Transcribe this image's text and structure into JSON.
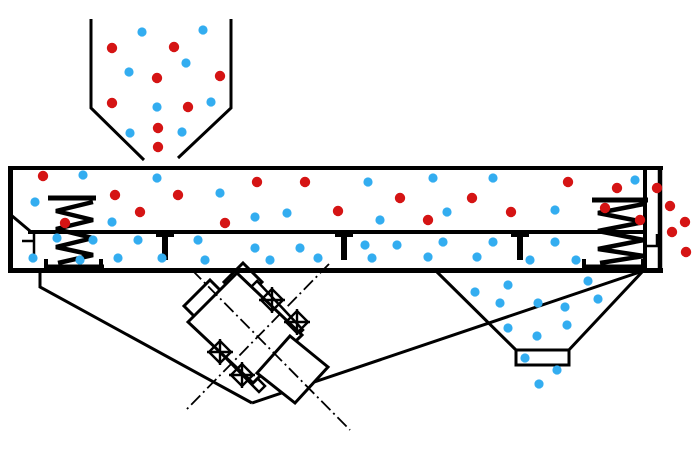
{
  "diagram": {
    "type": "technical-schematic",
    "subject": "linear vibrating screen side view with particle flow",
    "background_color": "#ffffff",
    "line_color": "#000000",
    "particle_colors": {
      "coarse": "#d51414",
      "fine": "#33adf0"
    },
    "particle_radius": {
      "coarse": 5.2,
      "fine": 4.6
    },
    "components": [
      "feed-hopper",
      "screen-box",
      "screen-mesh",
      "mesh-supports",
      "left-support-spring",
      "right-support-spring",
      "vibration-motor",
      "motor-centerlines",
      "motor-bolts",
      "chute-frame",
      "fines-discharge-funnel",
      "funnel-spout",
      "overflow-outlet"
    ],
    "particles": {
      "hopper_coarse": [
        [
          112,
          48
        ],
        [
          174,
          47
        ],
        [
          220,
          76
        ],
        [
          157,
          78
        ],
        [
          112,
          103
        ],
        [
          188,
          107
        ],
        [
          158,
          128
        ],
        [
          158,
          147
        ]
      ],
      "hopper_fine": [
        [
          142,
          32
        ],
        [
          203,
          30
        ],
        [
          186,
          63
        ],
        [
          129,
          72
        ],
        [
          157,
          107
        ],
        [
          211,
          102
        ],
        [
          130,
          133
        ],
        [
          182,
          132
        ]
      ],
      "deck_coarse": [
        [
          43,
          176
        ],
        [
          115,
          195
        ],
        [
          140,
          212
        ],
        [
          65,
          223
        ],
        [
          178,
          195
        ],
        [
          225,
          223
        ],
        [
          257,
          182
        ],
        [
          305,
          182
        ],
        [
          338,
          211
        ],
        [
          400,
          198
        ],
        [
          428,
          220
        ],
        [
          472,
          198
        ],
        [
          511,
          212
        ],
        [
          568,
          182
        ],
        [
          617,
          188
        ],
        [
          657,
          188
        ],
        [
          605,
          208
        ],
        [
          640,
          220
        ]
      ],
      "deck_fine": [
        [
          83,
          175
        ],
        [
          35,
          202
        ],
        [
          112,
          222
        ],
        [
          157,
          178
        ],
        [
          220,
          193
        ],
        [
          255,
          217
        ],
        [
          287,
          213
        ],
        [
          368,
          182
        ],
        [
          433,
          178
        ],
        [
          493,
          178
        ],
        [
          380,
          220
        ],
        [
          447,
          212
        ],
        [
          555,
          210
        ],
        [
          635,
          180
        ],
        [
          555,
          242
        ]
      ],
      "under_screen_fine": [
        [
          57,
          238
        ],
        [
          93,
          240
        ],
        [
          138,
          240
        ],
        [
          198,
          240
        ],
        [
          255,
          248
        ],
        [
          300,
          248
        ],
        [
          365,
          245
        ],
        [
          397,
          245
        ],
        [
          443,
          242
        ],
        [
          493,
          242
        ],
        [
          33,
          258
        ],
        [
          80,
          260
        ],
        [
          118,
          258
        ],
        [
          162,
          258
        ],
        [
          205,
          260
        ],
        [
          270,
          260
        ],
        [
          318,
          258
        ],
        [
          372,
          258
        ],
        [
          428,
          257
        ],
        [
          477,
          257
        ],
        [
          530,
          260
        ],
        [
          576,
          260
        ]
      ],
      "funnel_fine": [
        [
          475,
          292
        ],
        [
          508,
          285
        ],
        [
          588,
          281
        ],
        [
          500,
          303
        ],
        [
          538,
          303
        ],
        [
          565,
          307
        ],
        [
          598,
          299
        ],
        [
          508,
          328
        ],
        [
          567,
          325
        ],
        [
          537,
          336
        ]
      ],
      "spout_fine": [
        [
          525,
          358
        ],
        [
          557,
          370
        ],
        [
          539,
          384
        ]
      ],
      "overflow_coarse": [
        [
          670,
          206
        ],
        [
          685,
          222
        ],
        [
          672,
          232
        ],
        [
          686,
          252
        ]
      ]
    }
  }
}
